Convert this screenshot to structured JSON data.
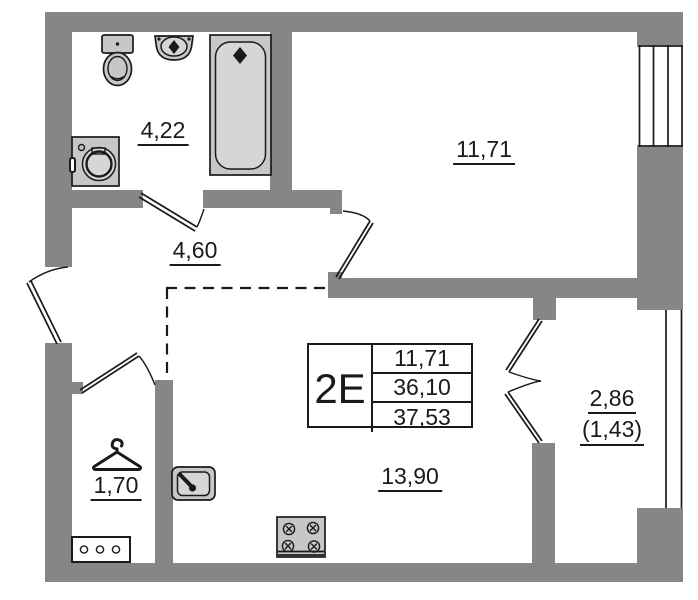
{
  "unit": {
    "code": "2E",
    "table_rows": [
      "11,71",
      "36,10",
      "37,53"
    ]
  },
  "rooms": {
    "bathroom": {
      "area": "4,22"
    },
    "hallway": {
      "area": "4,60"
    },
    "bedroom": {
      "area": "11,71"
    },
    "closet": {
      "area": "1,70"
    },
    "kitchen_living": {
      "area": "13,90"
    },
    "balcony": {
      "area": "2,86",
      "area_secondary": "(1,43)"
    }
  },
  "fixtures": [
    "toilet-icon",
    "wall-sink-icon",
    "bathtub-icon",
    "washing-machine-icon",
    "wardrobe-hanger-icon",
    "shoe-cabinet-icon",
    "kitchen-sink-icon",
    "stove-icon"
  ],
  "colors": {
    "wall": "#868686",
    "fixture": "#c7c7c7",
    "fixture_light": "#d6d6d6",
    "line": "#1a1a1a"
  }
}
